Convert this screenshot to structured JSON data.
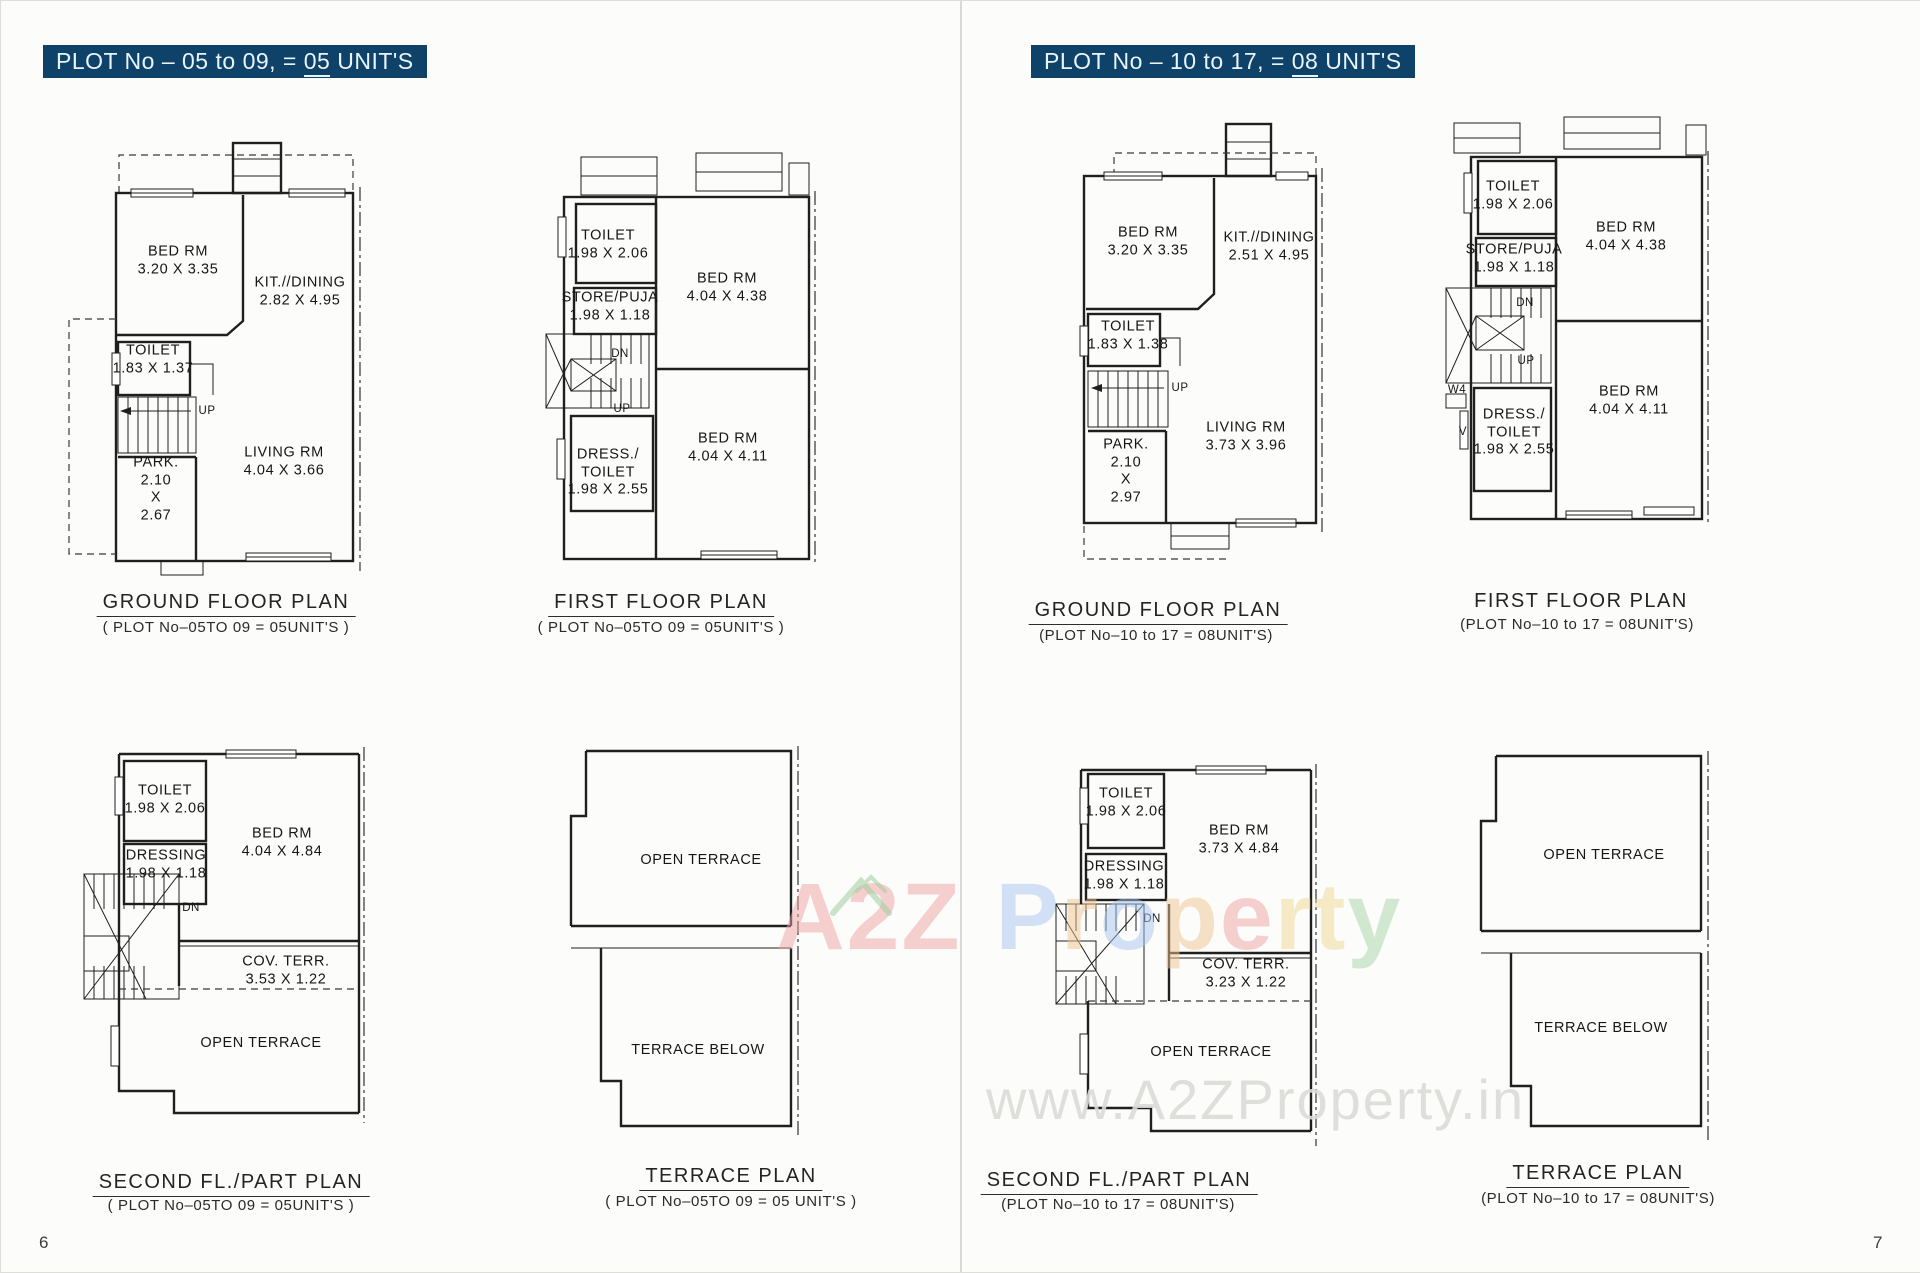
{
  "pages": [
    {
      "number": "6",
      "title": {
        "pre": "PLOT No – 05 to 09, = ",
        "num": "05",
        "post": " UNIT'S"
      },
      "plans": [
        {
          "caption": "GROUND FLOOR PLAN",
          "subcaption": "( PLOT No–05TO 09 = 05UNIT'S )",
          "rooms": [
            {
              "lines": [
                "BED RM",
                "3.20 X 3.35"
              ]
            },
            {
              "lines": [
                "KIT.//DINING",
                "2.82 X 4.95"
              ]
            },
            {
              "lines": [
                "TOILET",
                "1.83 X 1.37"
              ]
            },
            {
              "lines": [
                "LIVING RM",
                "4.04 X 3.66"
              ]
            },
            {
              "lines": [
                "PARK.",
                "2.10",
                "X",
                "2.67"
              ]
            }
          ],
          "stairs": [
            {
              "label": "UP"
            }
          ]
        },
        {
          "caption": "FIRST FLOOR PLAN",
          "subcaption": "( PLOT No–05TO 09 = 05UNIT'S )",
          "rooms": [
            {
              "lines": [
                "TOILET",
                "1.98 X 2.06"
              ]
            },
            {
              "lines": [
                "STORE/PUJA",
                "1.98 X 1.18"
              ]
            },
            {
              "lines": [
                "BED RM",
                "4.04 X 4.38"
              ]
            },
            {
              "lines": [
                "DRESS./",
                "TOILET",
                "1.98 X 2.55"
              ]
            },
            {
              "lines": [
                "BED RM",
                "4.04 X 4.11"
              ]
            }
          ],
          "stairs": [
            {
              "label": "DN"
            },
            {
              "label": "UP"
            }
          ]
        },
        {
          "caption": "SECOND FL./PART PLAN",
          "subcaption": "( PLOT No–05TO 09 = 05UNIT'S )",
          "rooms": [
            {
              "lines": [
                "TOILET",
                "1.98 X 2.06"
              ]
            },
            {
              "lines": [
                "DRESSING",
                "1.98 X 1.18"
              ]
            },
            {
              "lines": [
                "BED RM",
                "4.04 X 4.84"
              ]
            },
            {
              "lines": [
                "COV. TERR.",
                "3.53 X 1.22"
              ]
            },
            {
              "lines": [
                "OPEN TERRACE"
              ]
            }
          ],
          "stairs": [
            {
              "label": "DN"
            }
          ]
        },
        {
          "caption": "TERRACE PLAN",
          "subcaption": "( PLOT No–05TO 09 = 05 UNIT'S )",
          "rooms": [
            {
              "lines": [
                "OPEN TERRACE"
              ]
            },
            {
              "lines": [
                "TERRACE BELOW"
              ]
            }
          ],
          "stairs": []
        }
      ]
    },
    {
      "number": "7",
      "title": {
        "pre": "PLOT No – 10 to 17, = ",
        "num": "08",
        "post": " UNIT'S"
      },
      "plans": [
        {
          "caption": "GROUND FLOOR PLAN",
          "subcaption": "(PLOT No–10 to 17 = 08UNIT'S)",
          "rooms": [
            {
              "lines": [
                "BED RM",
                "3.20 X 3.35"
              ]
            },
            {
              "lines": [
                "KIT.//DINING",
                "2.51 X 4.95"
              ]
            },
            {
              "lines": [
                "TOILET",
                "1.83 X 1.38"
              ]
            },
            {
              "lines": [
                "LIVING RM",
                "3.73 X 3.96"
              ]
            },
            {
              "lines": [
                "PARK.",
                "2.10",
                "X",
                "2.97"
              ]
            }
          ],
          "stairs": [
            {
              "label": "UP"
            }
          ]
        },
        {
          "caption": "FIRST FLOOR PLAN",
          "subcaption": "(PLOT No–10 to 17 = 08UNIT'S)",
          "rooms": [
            {
              "lines": [
                "TOILET",
                "1.98 X 2.06"
              ]
            },
            {
              "lines": [
                "STORE/PUJA",
                "1.98 X 1.18"
              ]
            },
            {
              "lines": [
                "BED RM",
                "4.04 X 4.38"
              ]
            },
            {
              "lines": [
                "DRESS./",
                "TOILET",
                "1.98 X 2.55"
              ]
            },
            {
              "lines": [
                "BED RM",
                "4.04 X 4.11"
              ]
            }
          ],
          "stairs": [
            {
              "label": "DN"
            },
            {
              "label": "UP"
            }
          ],
          "marks": [
            {
              "label": "W4"
            },
            {
              "label": "V"
            }
          ]
        },
        {
          "caption": "SECOND FL./PART PLAN",
          "subcaption": "(PLOT No–10 to 17 = 08UNIT'S)",
          "rooms": [
            {
              "lines": [
                "TOILET",
                "1.98 X 2.06"
              ]
            },
            {
              "lines": [
                "DRESSING",
                "1.98 X 1.18"
              ]
            },
            {
              "lines": [
                "BED RM",
                "3.73 X 4.84"
              ]
            },
            {
              "lines": [
                "COV. TERR.",
                "3.23 X 1.22"
              ]
            },
            {
              "lines": [
                "OPEN TERRACE"
              ]
            }
          ],
          "stairs": [
            {
              "label": "DN"
            }
          ]
        },
        {
          "caption": "TERRACE PLAN",
          "subcaption": "(PLOT No–10 to 17 = 08UNIT'S)",
          "rooms": [
            {
              "lines": [
                "OPEN TERRACE"
              ]
            },
            {
              "lines": [
                "TERRACE BELOW"
              ]
            }
          ],
          "stairs": []
        }
      ]
    }
  ],
  "watermarks": {
    "brand": {
      "letters": [
        {
          "ch": "A",
          "color": "#f0a3a3"
        },
        {
          "ch": "2",
          "color": "#f0a3a3"
        },
        {
          "ch": "Z",
          "color": "#f0a3a3"
        },
        {
          "ch": "P",
          "color": "#a8c6f0"
        },
        {
          "ch": "r",
          "color": "#f2c692"
        },
        {
          "ch": "o",
          "color": "#a8c6f0"
        },
        {
          "ch": "p",
          "color": "#f2c692"
        },
        {
          "ch": "e",
          "color": "#f0a3a3"
        },
        {
          "ch": "r",
          "color": "#f2d892"
        },
        {
          "ch": "t",
          "color": "#f2d892"
        },
        {
          "ch": "y",
          "color": "#a5d6a5"
        }
      ]
    },
    "url": {
      "text": "www.A2ZProperty.in",
      "color": "#dbdbd8"
    }
  }
}
